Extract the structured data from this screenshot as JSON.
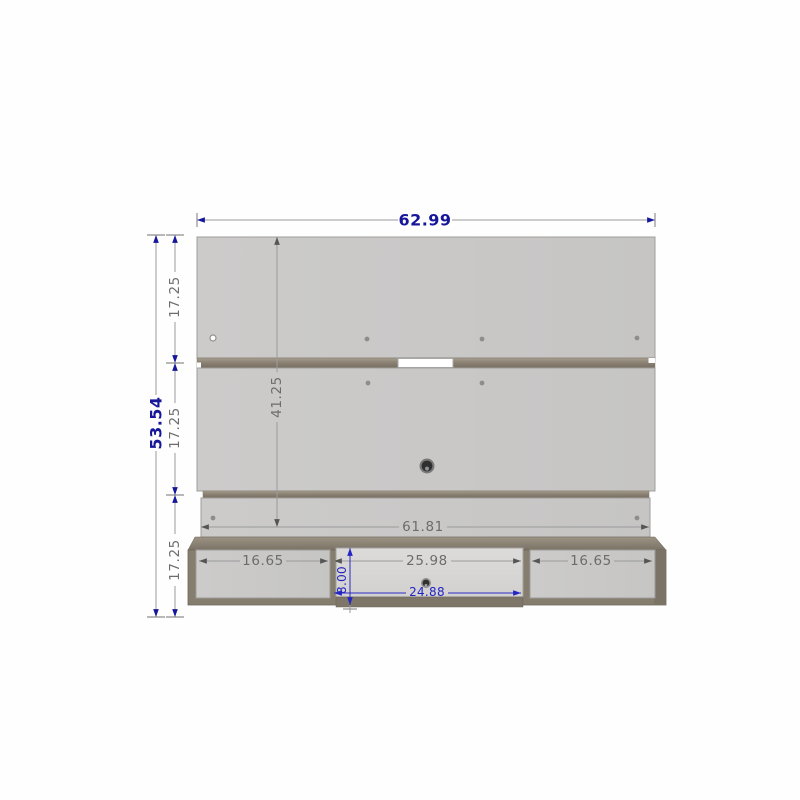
{
  "drawing": {
    "dims": {
      "overall_width": "62.99",
      "overall_height": "53.54",
      "upper_panel_height": "17.25",
      "middle_panel_height": "17.25",
      "lower_section_height": "17.25",
      "panel_span_height": "41.25",
      "bottom_rail_width": "61.81",
      "shelf_left_section_width": "16.65",
      "shelf_middle_section_width": "25.98",
      "shelf_right_section_width": "16.65",
      "shelf_section_height": "8.00",
      "shelf_opening_width": "24.88"
    },
    "colors": {
      "dim_accent_navy": "#16169a",
      "dim_gray": "#6c6c6c",
      "dim_blue": "#2424c4",
      "panel_gray": "#c9c8c7",
      "trim_taupe": "#8d8476",
      "shelf_taupe": "#857d6e",
      "background": "#fefefe"
    }
  }
}
